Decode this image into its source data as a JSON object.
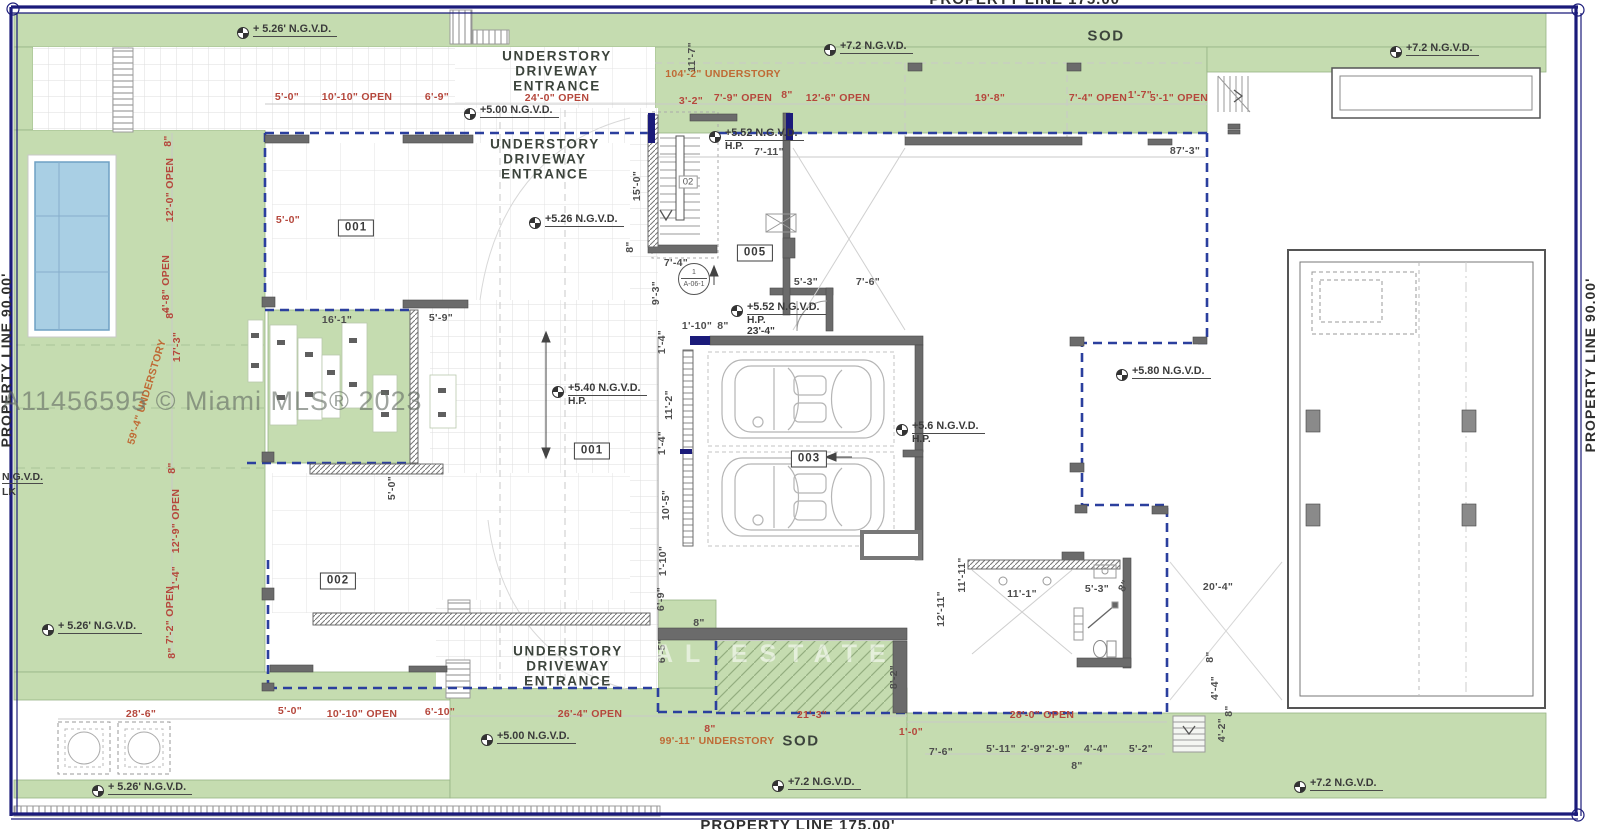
{
  "canvas": {
    "w": 1600,
    "h": 829
  },
  "colors": {
    "sod": "#c5dcb0",
    "sodline": "#97b385",
    "pool": "#a9cfe4",
    "nav": "#1b1b7a",
    "blue": "#2b3f9e",
    "wall": "#6b6b6b",
    "red": "#b5473c",
    "orange": "#bf6a35",
    "dark": "#4d4d4d",
    "label": "#3c443c"
  },
  "property_lines": {
    "top": "PROPERTY LINE 175.00'",
    "bottom": "PROPERTY LINE 175.00'",
    "left": "PROPERTY LINE 90.00'",
    "right": "PROPERTY LINE 90.00'"
  },
  "watermarks": {
    "mls": "A11456595 © Miami MLS® 2023",
    "ghost": "AL ESTATE"
  },
  "zone_labels": [
    {
      "text": "UNDERSTORY\nDRIVEWAY\nENTRANCE",
      "x": 557,
      "y": 71,
      "size": 13.5
    },
    {
      "text": "UNDERSTORY\nDRIVEWAY\nENTRANCE",
      "x": 545,
      "y": 159,
      "size": 13.5
    },
    {
      "text": "UNDERSTORY\nDRIVEWAY\nENTRANCE",
      "x": 568,
      "y": 666,
      "size": 13.5
    },
    {
      "text": "SOD",
      "x": 1106,
      "y": 36,
      "size": 15
    },
    {
      "text": "SOD",
      "x": 801,
      "y": 741,
      "size": 15
    }
  ],
  "room_tags": [
    {
      "id": "001",
      "x": 356,
      "y": 228
    },
    {
      "id": "001",
      "x": 592,
      "y": 451
    },
    {
      "id": "002",
      "x": 338,
      "y": 581
    },
    {
      "id": "003",
      "x": 809,
      "y": 459
    },
    {
      "id": "005",
      "x": 755,
      "y": 253
    }
  ],
  "stair_label": {
    "t": "02",
    "x": 688,
    "y": 182
  },
  "detail_ref": {
    "top": "1",
    "bottom": "A-06-1",
    "x": 694,
    "y": 279
  },
  "edge_texts": [
    {
      "t": "N.G.V.D.",
      "x": 2,
      "y": 471,
      "u": true
    },
    {
      "t": "LK",
      "x": 2,
      "y": 486,
      "u": false
    }
  ],
  "elevation_markers": [
    {
      "t": "+ 5.26' N.G.V.D.",
      "x": 243,
      "y": 33,
      "sub": []
    },
    {
      "t": "+7.2 N.G.V.D.",
      "x": 830,
      "y": 50,
      "sub": []
    },
    {
      "t": "+7.2 N.G.V.D.",
      "x": 1396,
      "y": 52,
      "sub": []
    },
    {
      "t": "+5.00 N.G.V.D.",
      "x": 470,
      "y": 114,
      "sub": []
    },
    {
      "t": "+5.52 N.G.V.D.",
      "x": 715,
      "y": 137,
      "sub": [
        "H.P."
      ]
    },
    {
      "t": "+5.26 N.G.V.D.",
      "x": 535,
      "y": 223,
      "sub": []
    },
    {
      "t": "+5.52 N.G.V.D.",
      "x": 737,
      "y": 311,
      "sub": [
        "H.P.",
        "23'-4\""
      ]
    },
    {
      "t": "+5.40 N.G.V.D.",
      "x": 558,
      "y": 392,
      "sub": [
        "H.P."
      ]
    },
    {
      "t": "+5.6 N.G.V.D.",
      "x": 902,
      "y": 430,
      "sub": [
        "H.P."
      ]
    },
    {
      "t": "+5.80 N.G.V.D.",
      "x": 1122,
      "y": 375,
      "sub": []
    },
    {
      "t": "+ 5.26' N.G.V.D.",
      "x": 48,
      "y": 630,
      "sub": []
    },
    {
      "t": "+ 5.26' N.G.V.D.",
      "x": 98,
      "y": 791,
      "sub": []
    },
    {
      "t": "+5.00 N.G.V.D.",
      "x": 487,
      "y": 740,
      "sub": []
    },
    {
      "t": "+7.2 N.G.V.D.",
      "x": 778,
      "y": 786,
      "sub": []
    },
    {
      "t": "+7.2 N.G.V.D.",
      "x": 1300,
      "y": 787,
      "sub": []
    }
  ],
  "dimensions": [
    {
      "t": "5'-0\"",
      "x": 287,
      "y": 97,
      "c": "red"
    },
    {
      "t": "10'-10\" OPEN",
      "x": 357,
      "y": 97,
      "c": "red"
    },
    {
      "t": "6'-9\"",
      "x": 437,
      "y": 97,
      "c": "red"
    },
    {
      "t": "24'-0\" OPEN",
      "x": 557,
      "y": 98,
      "c": "red"
    },
    {
      "t": "3'-2\"",
      "x": 691,
      "y": 101,
      "c": "red"
    },
    {
      "t": "7'-9\" OPEN",
      "x": 743,
      "y": 98,
      "c": "red"
    },
    {
      "t": "8\"",
      "x": 787,
      "y": 95,
      "c": "red"
    },
    {
      "t": "12'-6\" OPEN",
      "x": 838,
      "y": 98,
      "c": "red"
    },
    {
      "t": "19'-8\"",
      "x": 990,
      "y": 98,
      "c": "red"
    },
    {
      "t": "7'-4\" OPEN",
      "x": 1098,
      "y": 98,
      "c": "red"
    },
    {
      "t": "1'-7\"",
      "x": 1140,
      "y": 95,
      "c": "red"
    },
    {
      "t": "5'-1\" OPEN",
      "x": 1179,
      "y": 98,
      "c": "red"
    },
    {
      "t": "104'-2\" UNDERSTORY",
      "x": 723,
      "y": 74,
      "c": "orange"
    },
    {
      "t": "87'-3\"",
      "x": 1185,
      "y": 151,
      "c": "dark"
    },
    {
      "t": "11'-7\"",
      "x": 692,
      "y": 57,
      "c": "dark",
      "r": -90
    },
    {
      "t": "8\"",
      "x": 168,
      "y": 141,
      "c": "red",
      "r": -90
    },
    {
      "t": "12'-0\" OPEN",
      "x": 170,
      "y": 190,
      "c": "red",
      "r": -90
    },
    {
      "t": "4'-8\" OPEN",
      "x": 166,
      "y": 284,
      "c": "red",
      "r": -90
    },
    {
      "t": "8\"",
      "x": 170,
      "y": 313,
      "c": "red",
      "r": -90
    },
    {
      "t": "17'-3\"",
      "x": 177,
      "y": 347,
      "c": "red",
      "r": -90
    },
    {
      "t": "59'-4\" UNDERSTORY",
      "x": 147,
      "y": 392,
      "c": "orange",
      "r": -73
    },
    {
      "t": "8\"",
      "x": 172,
      "y": 468,
      "c": "red",
      "r": -90
    },
    {
      "t": "12'-9\" OPEN",
      "x": 176,
      "y": 521,
      "c": "red",
      "r": -90
    },
    {
      "t": "1'-4\"",
      "x": 176,
      "y": 578,
      "c": "red",
      "r": -90
    },
    {
      "t": "7'-2\" OPEN",
      "x": 170,
      "y": 615,
      "c": "red",
      "r": -90
    },
    {
      "t": "8\"",
      "x": 172,
      "y": 653,
      "c": "red",
      "r": -90
    },
    {
      "t": "15'-0\"",
      "x": 637,
      "y": 186,
      "c": "dark",
      "r": -90
    },
    {
      "t": "8\"",
      "x": 630,
      "y": 247,
      "c": "dark",
      "r": -90
    },
    {
      "t": "9'-3\"",
      "x": 656,
      "y": 293,
      "c": "dark",
      "r": -90
    },
    {
      "t": "1'-4\"",
      "x": 662,
      "y": 342,
      "c": "dark",
      "r": -90
    },
    {
      "t": "11'-2\"",
      "x": 669,
      "y": 405,
      "c": "dark",
      "r": -90
    },
    {
      "t": "1'-4\"",
      "x": 662,
      "y": 443,
      "c": "dark",
      "r": -90
    },
    {
      "t": "10'-5\"",
      "x": 666,
      "y": 505,
      "c": "dark",
      "r": -90
    },
    {
      "t": "1'-10\"",
      "x": 663,
      "y": 561,
      "c": "dark",
      "r": -90
    },
    {
      "t": "6'-9\"",
      "x": 661,
      "y": 599,
      "c": "dark",
      "r": -90
    },
    {
      "t": "6'-5\"",
      "x": 662,
      "y": 651,
      "c": "dark",
      "r": -90
    },
    {
      "t": "5'-0\"",
      "x": 288,
      "y": 220,
      "c": "red"
    },
    {
      "t": "16'-1\"",
      "x": 337,
      "y": 320,
      "c": "dark"
    },
    {
      "t": "5'-9\"",
      "x": 441,
      "y": 318,
      "c": "dark"
    },
    {
      "t": "5'-0\"",
      "x": 392,
      "y": 488,
      "c": "dark",
      "r": -90
    },
    {
      "t": "7'-4\"",
      "x": 676,
      "y": 263,
      "c": "dark"
    },
    {
      "t": "7'-11\"",
      "x": 769,
      "y": 152,
      "c": "dark"
    },
    {
      "t": "1'-10\"",
      "x": 697,
      "y": 326,
      "c": "dark"
    },
    {
      "t": "8\"",
      "x": 723,
      "y": 326,
      "c": "dark"
    },
    {
      "t": "5'-3\"",
      "x": 806,
      "y": 282,
      "c": "dark"
    },
    {
      "t": "7'-6\"",
      "x": 868,
      "y": 282,
      "c": "dark"
    },
    {
      "t": "8\"",
      "x": 699,
      "y": 623,
      "c": "dark"
    },
    {
      "t": "8'-2\"",
      "x": 894,
      "y": 677,
      "c": "dark",
      "r": -90
    },
    {
      "t": "11'-11\"",
      "x": 962,
      "y": 575,
      "c": "dark",
      "r": -90
    },
    {
      "t": "12'-11\"",
      "x": 941,
      "y": 609,
      "c": "dark",
      "r": -90
    },
    {
      "t": "11'-1\"",
      "x": 1022,
      "y": 594,
      "c": "dark"
    },
    {
      "t": "5'-3\"",
      "x": 1097,
      "y": 589,
      "c": "dark"
    },
    {
      "t": "8\"",
      "x": 1124,
      "y": 586,
      "c": "dark",
      "r": -60
    },
    {
      "t": "20'-4\"",
      "x": 1218,
      "y": 587,
      "c": "dark"
    },
    {
      "t": "8\"",
      "x": 1210,
      "y": 657,
      "c": "dark",
      "r": -90
    },
    {
      "t": "4'-4\"",
      "x": 1215,
      "y": 688,
      "c": "dark",
      "r": -90
    },
    {
      "t": "8\"",
      "x": 1229,
      "y": 711,
      "c": "dark",
      "r": -90
    },
    {
      "t": "4'-2\"",
      "x": 1222,
      "y": 730,
      "c": "dark",
      "r": -90
    },
    {
      "t": "28'-6\"",
      "x": 141,
      "y": 714,
      "c": "red"
    },
    {
      "t": "5'-0\"",
      "x": 290,
      "y": 711,
      "c": "red"
    },
    {
      "t": "10'-10\" OPEN",
      "x": 362,
      "y": 714,
      "c": "red"
    },
    {
      "t": "6'-10\"",
      "x": 440,
      "y": 712,
      "c": "red"
    },
    {
      "t": "26'-4\" OPEN",
      "x": 590,
      "y": 714,
      "c": "red"
    },
    {
      "t": "21'-3\"",
      "x": 812,
      "y": 715,
      "c": "red"
    },
    {
      "t": "1'-0\"",
      "x": 911,
      "y": 732,
      "c": "red"
    },
    {
      "t": "28'-0\" OPEN",
      "x": 1042,
      "y": 715,
      "c": "red"
    },
    {
      "t": "99'-11\" UNDERSTORY",
      "x": 717,
      "y": 741,
      "c": "orange"
    },
    {
      "t": "8\"",
      "x": 710,
      "y": 729,
      "c": "red"
    },
    {
      "t": "7'-6\"",
      "x": 941,
      "y": 752,
      "c": "dark"
    },
    {
      "t": "5'-11\"",
      "x": 1001,
      "y": 749,
      "c": "dark"
    },
    {
      "t": "2'-9\"",
      "x": 1033,
      "y": 749,
      "c": "dark"
    },
    {
      "t": "2'-9\"",
      "x": 1058,
      "y": 749,
      "c": "dark"
    },
    {
      "t": "4'-4\"",
      "x": 1096,
      "y": 749,
      "c": "dark"
    },
    {
      "t": "5'-2\"",
      "x": 1141,
      "y": 749,
      "c": "dark"
    },
    {
      "t": "8\"",
      "x": 1077,
      "y": 766,
      "c": "dark"
    }
  ]
}
